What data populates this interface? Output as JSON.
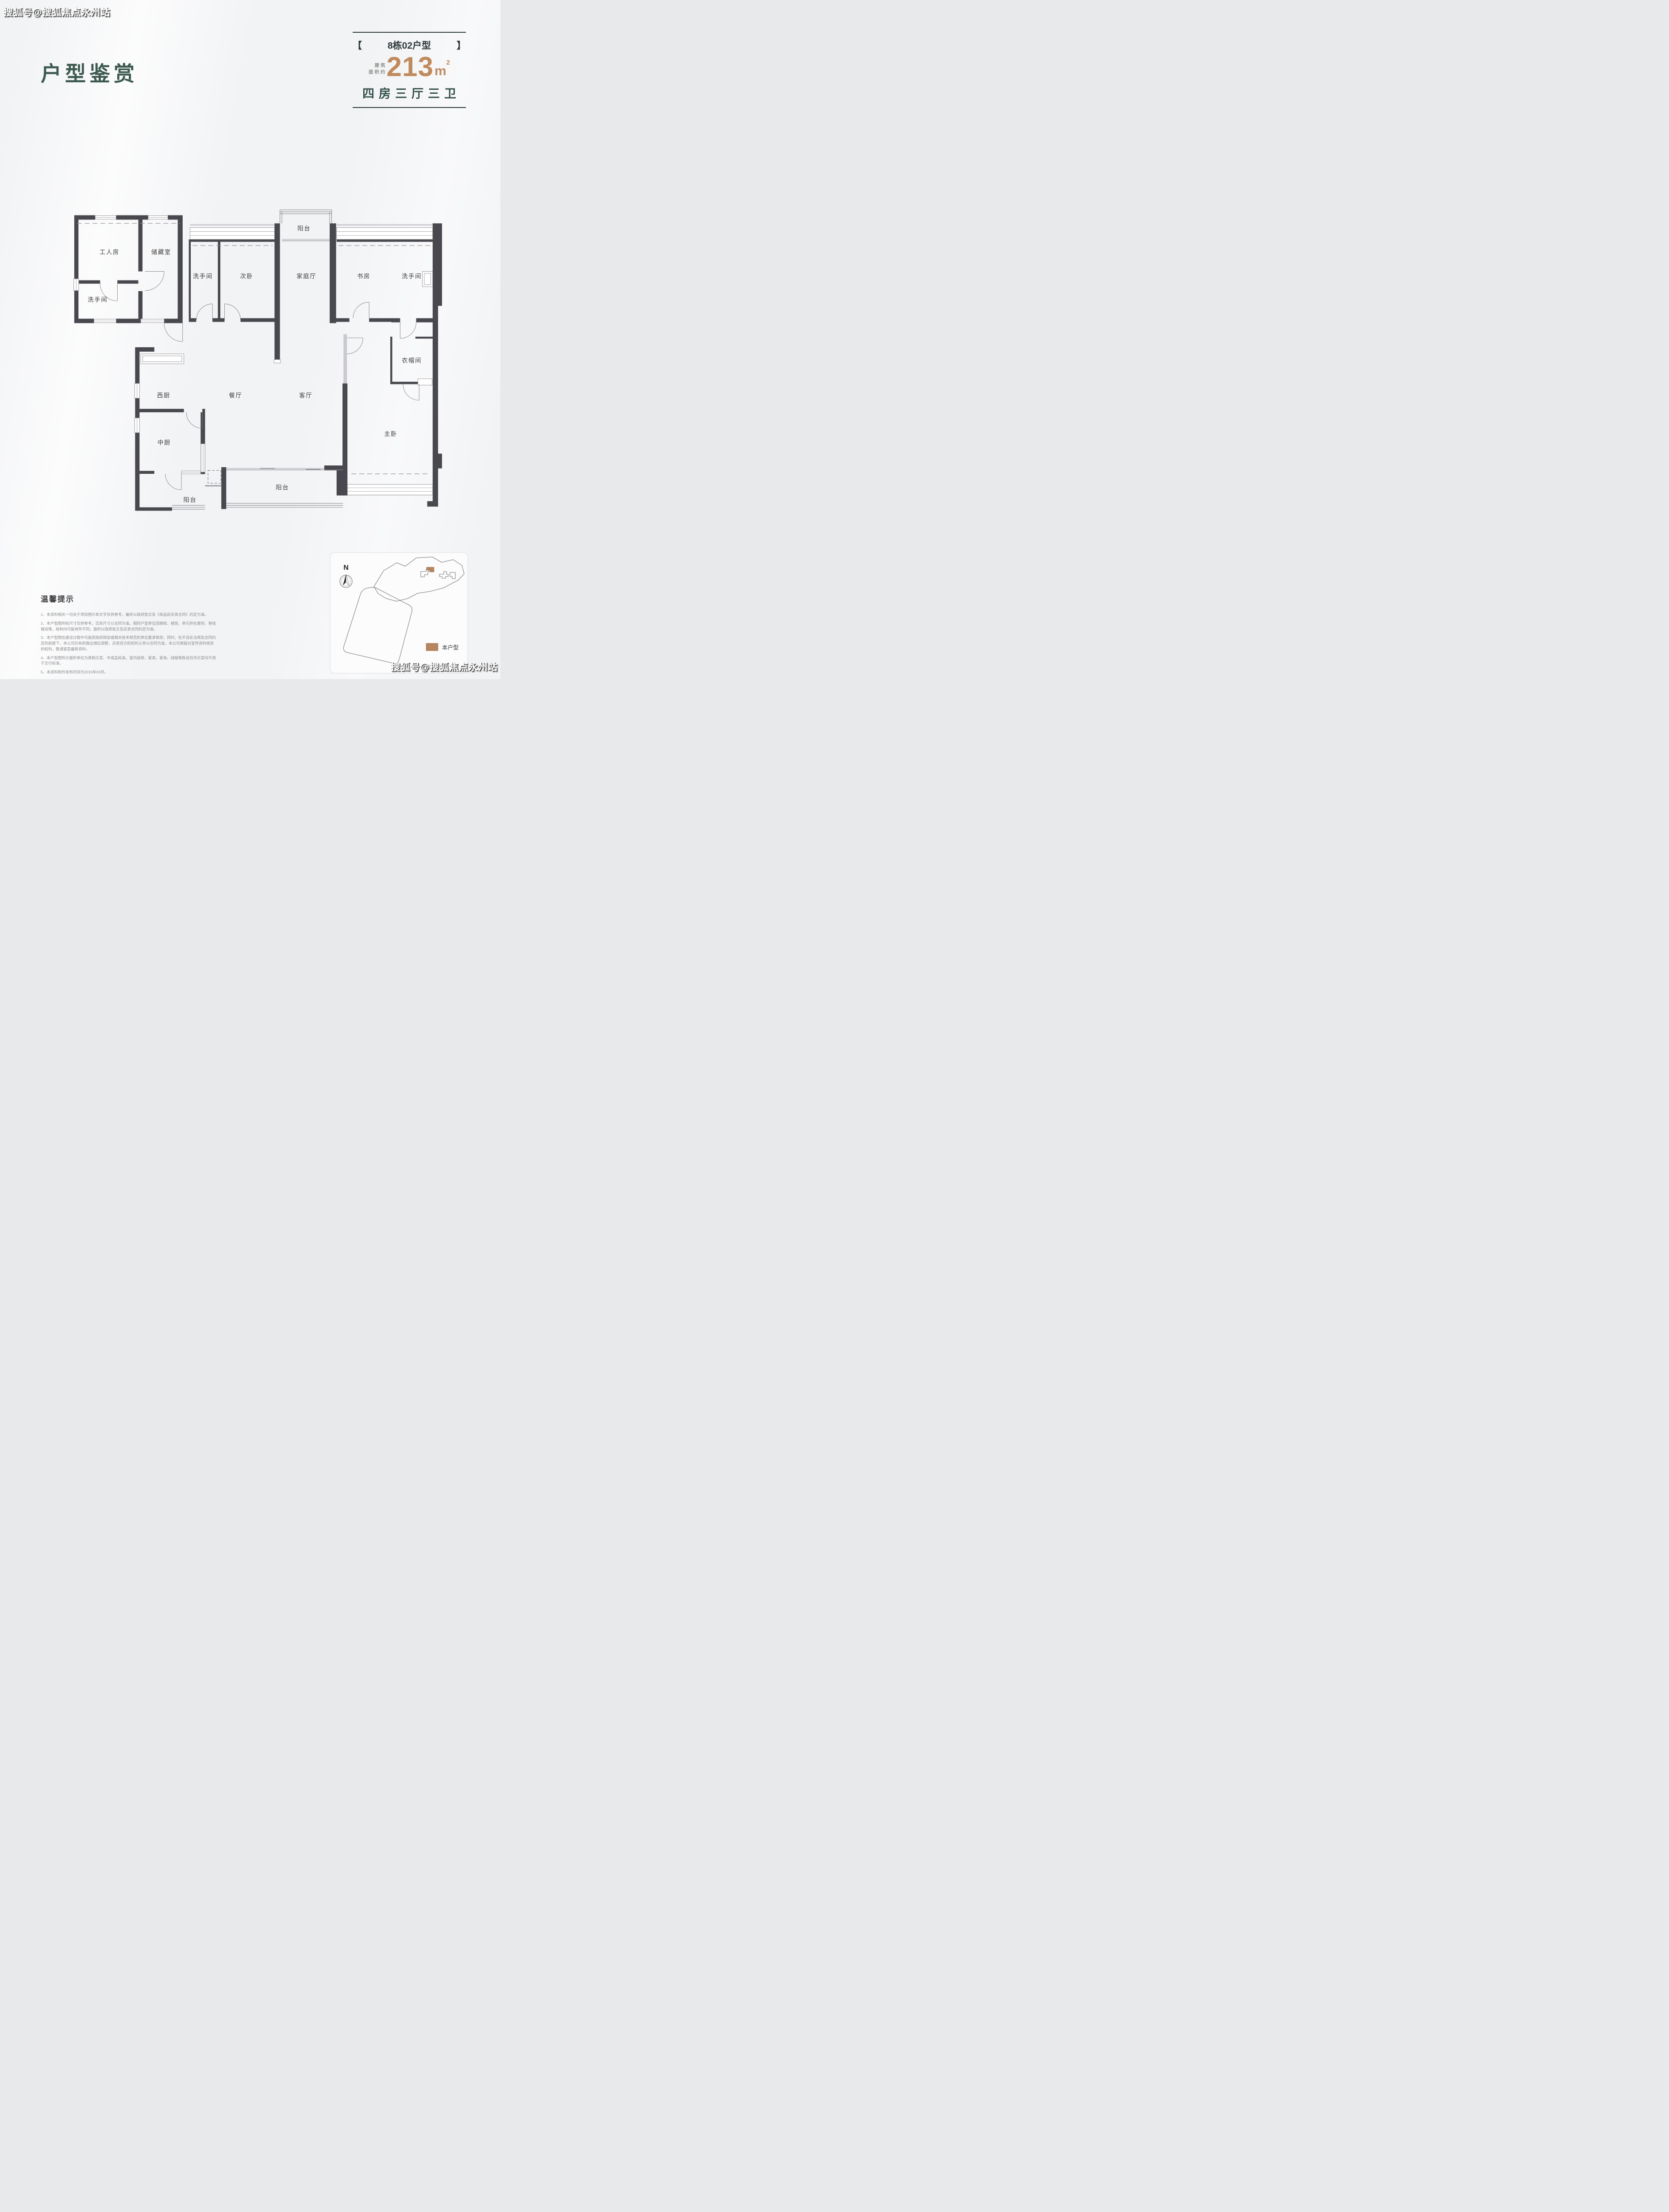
{
  "watermarks": {
    "top_left": "搜狐号@搜狐焦点永州站",
    "bottom_right": "搜狐号@搜狐焦点永州站"
  },
  "header": {
    "title": "户型鉴赏"
  },
  "unit": {
    "bracket_left": "【",
    "bracket_right": "】",
    "name": "8栋02户型",
    "area_prefix_line1": "建筑",
    "area_prefix_line2": "面积约",
    "area_value": "213",
    "area_unit": "m",
    "area_sup": "2",
    "layout": "四房三厅三卫"
  },
  "floor_plan": {
    "wall_color": "#48484e",
    "rooms": [
      {
        "label": "工人房"
      },
      {
        "label": "储藏室"
      },
      {
        "label": "洗手间"
      },
      {
        "label": "洗手间"
      },
      {
        "label": "次卧"
      },
      {
        "label": "阳台"
      },
      {
        "label": "家庭厅"
      },
      {
        "label": "书房"
      },
      {
        "label": "洗手间"
      },
      {
        "label": "衣帽间"
      },
      {
        "label": "西厨"
      },
      {
        "label": "餐厅"
      },
      {
        "label": "客厅"
      },
      {
        "label": "主卧"
      },
      {
        "label": "中厨"
      },
      {
        "label": "阳台"
      },
      {
        "label": "阳台"
      }
    ]
  },
  "site_map": {
    "north_label": "N",
    "legend_label": "本户型",
    "highlight_color": "#b5855f"
  },
  "tips": {
    "title": "温馨提示",
    "items": [
      "1、本资料相关一切关于项目图片和文字仅供参考，最终以政府批文及《商品房买卖合同》约定为准。",
      "2、本户型图所标尺寸仅供参考，实际尺寸以合同为准。相同户型单位因楼栋、楼层、单元所在差别、管线铺设等，结构均可能有所不同，面积以政府批文及买卖合同约定为准。",
      "3、本户型图在建设过程中可能因政府规划或相关技术规范的单位要求修改，同时，在不违反法规及合同约定的前提下，本公司仍有权做出相应调整，买卖双方的权利义务以合同为准，本公司保留对宣传资料修改的权利，敬请留意最新资料。",
      "4、本户型图所示面积单位为英制示意、半成品标准，室内装修、家具、家电、绿植等陈设仅作示意均不用于交付标准。",
      "5、本资料制作发布时间为2015年03月。"
    ]
  }
}
